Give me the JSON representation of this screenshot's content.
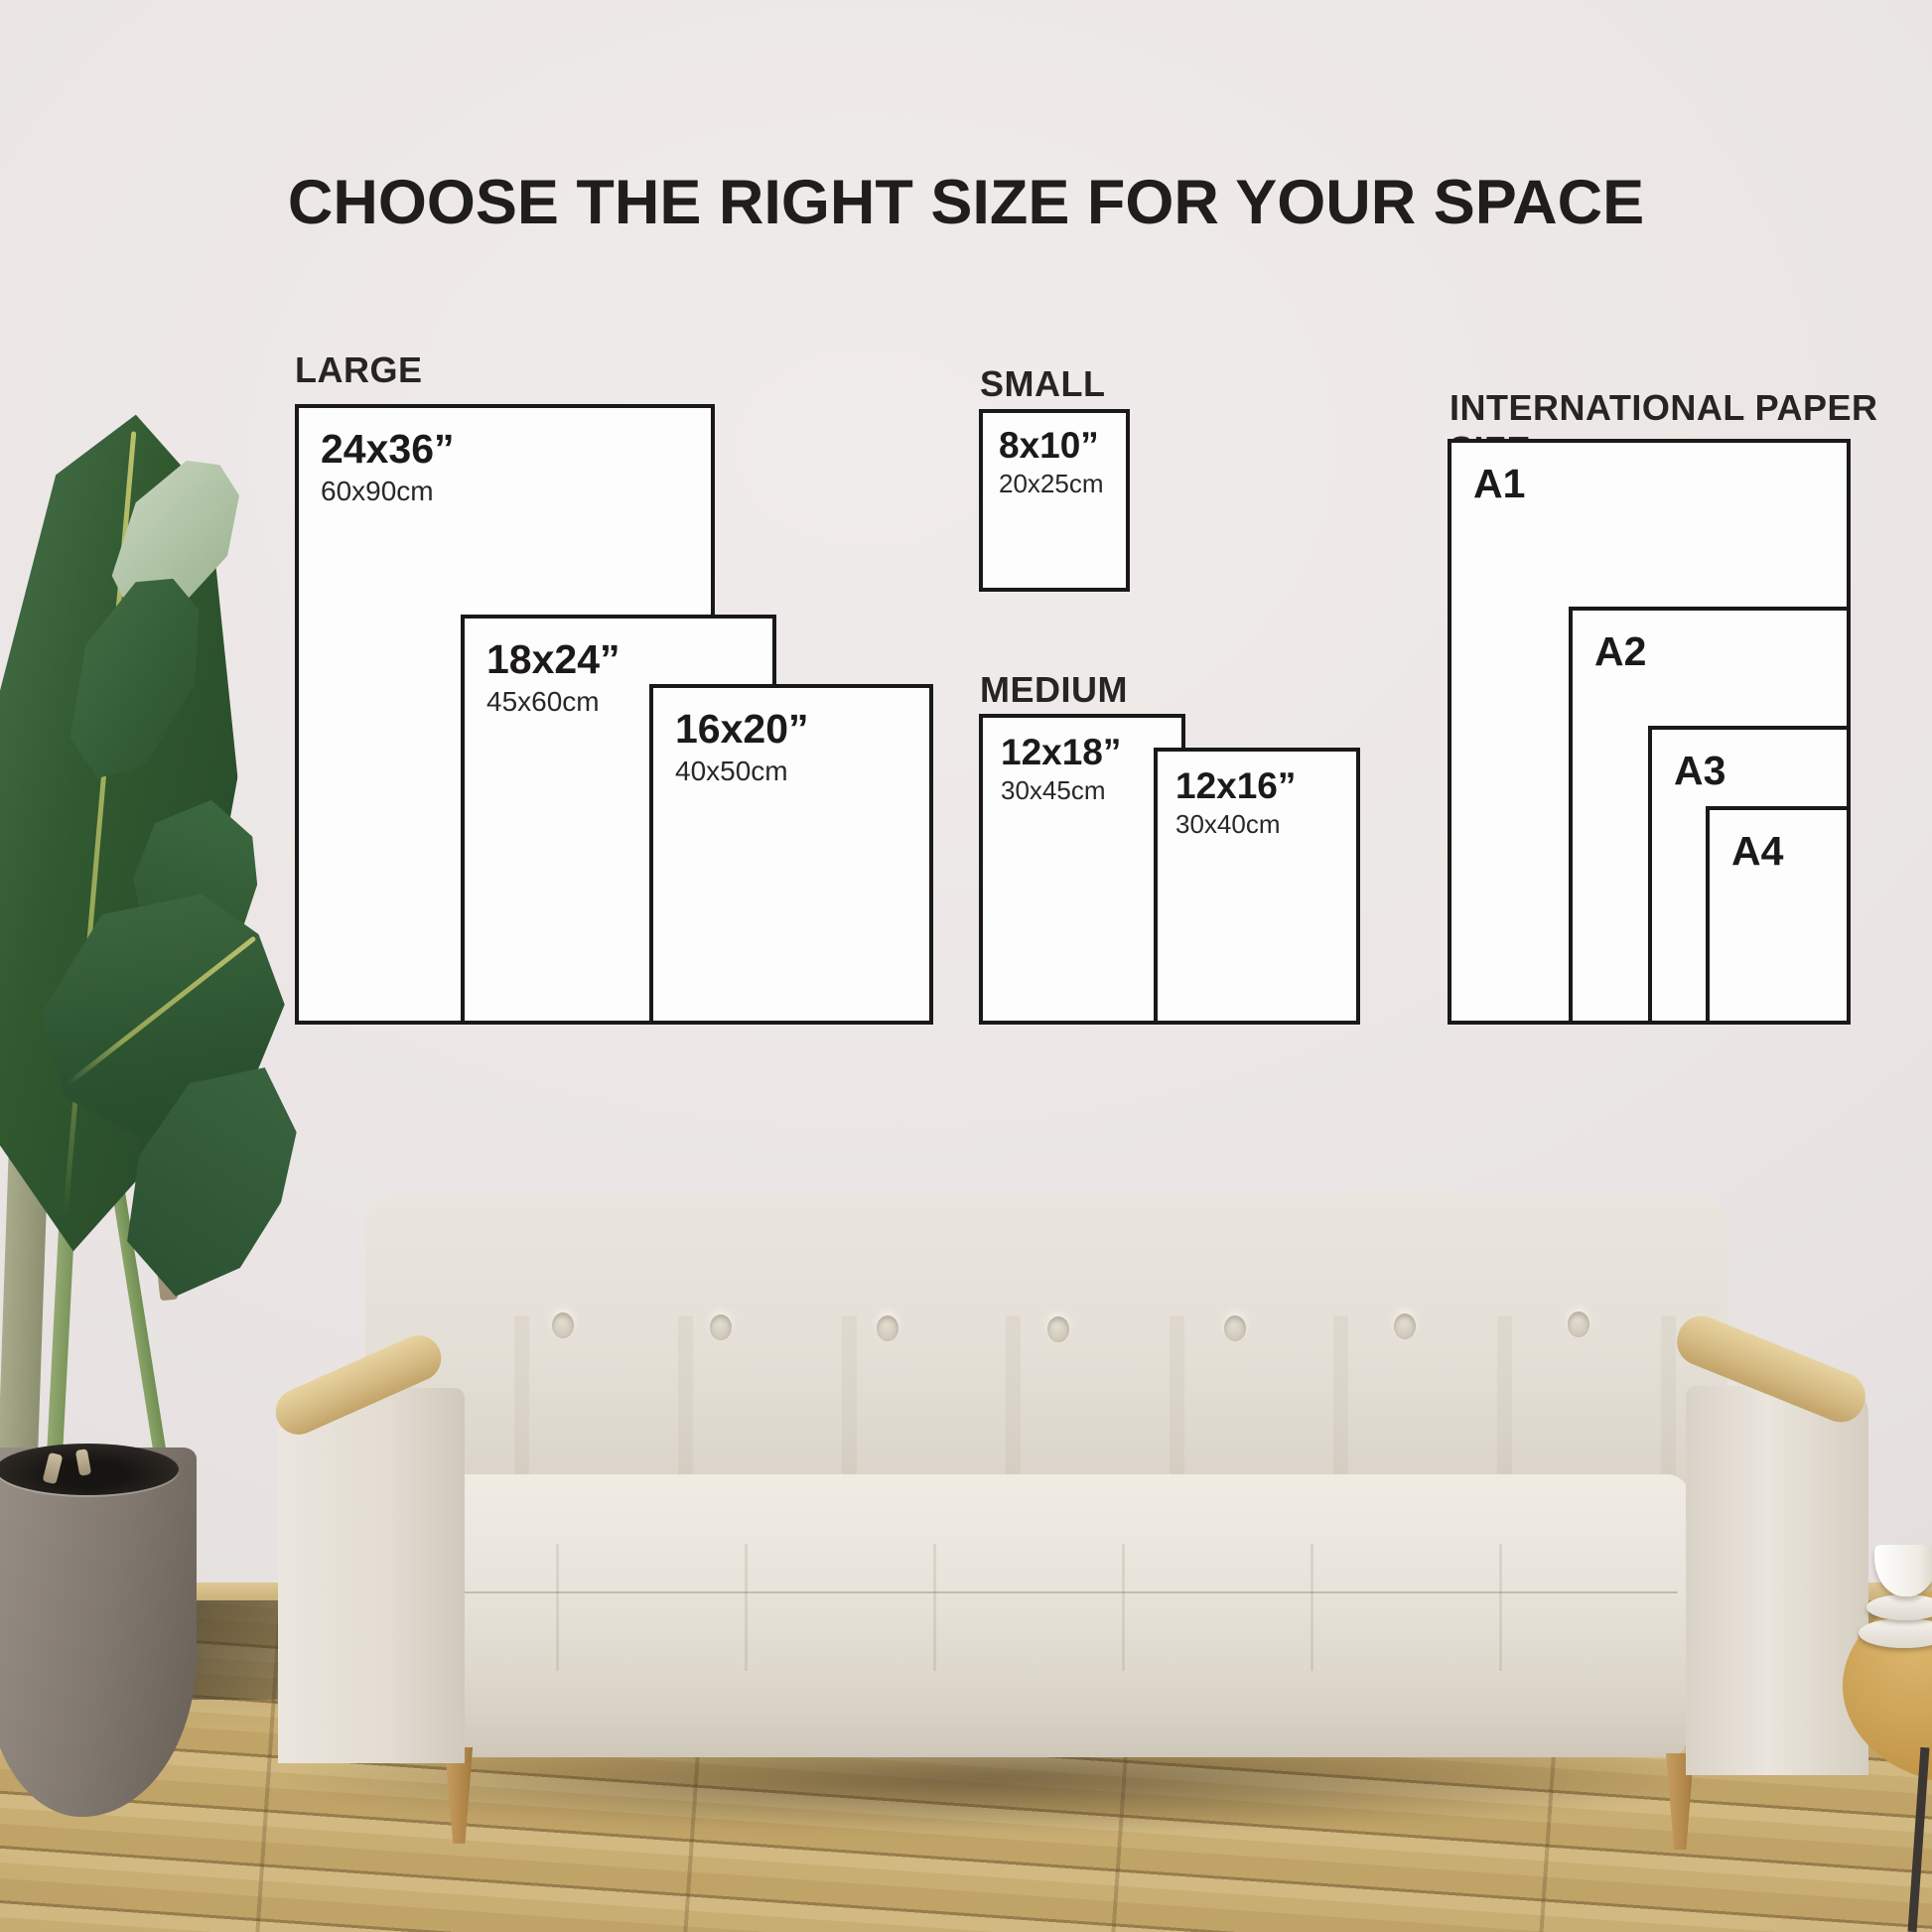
{
  "title": "CHOOSE THE RIGHT SIZE FOR YOUR SPACE",
  "groups": [
    {
      "label": "LARGE",
      "sizes": [
        {
          "inches": "24x36”",
          "cm": "60x90cm"
        },
        {
          "inches": "18x24”",
          "cm": "45x60cm"
        },
        {
          "inches": "16x20”",
          "cm": "40x50cm"
        }
      ]
    },
    {
      "label": "SMALL",
      "sizes": [
        {
          "inches": "8x10”",
          "cm": "20x25cm"
        }
      ]
    },
    {
      "label": "MEDIUM",
      "sizes": [
        {
          "inches": "12x18”",
          "cm": "30x45cm"
        },
        {
          "inches": "12x16”",
          "cm": "30x40cm"
        }
      ]
    },
    {
      "label": "INTERNATIONAL PAPER SIZE",
      "sizes": [
        {
          "inches": "A1"
        },
        {
          "inches": "A2"
        },
        {
          "inches": "A3"
        },
        {
          "inches": "A4"
        }
      ]
    }
  ],
  "colors": {
    "wall": "#eae5e4",
    "box_border": "#191919",
    "box_fill": "#fdfdfd",
    "text": "#1c1a19",
    "floor_wood": "#c9ae73",
    "sofa_fabric": "#e8e3da",
    "armrest_wood": "#d5bb84",
    "plant_leaf": "#2e5733",
    "pot": "#81786f"
  }
}
